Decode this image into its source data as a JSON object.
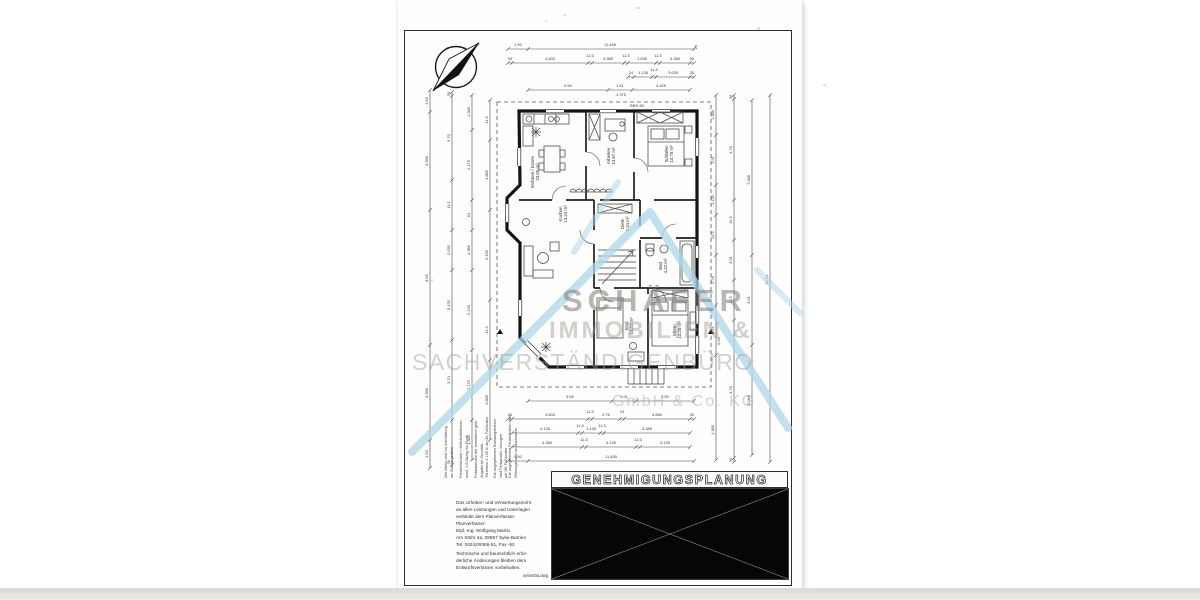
{
  "meta": {
    "document_type": "scanned architectural floor plan sheet"
  },
  "watermark": {
    "line1": "SCHÄFER",
    "line2": "IMMOBILIEN &",
    "line3": "SACHVERSTÄNDIGENBÜRO",
    "line4": "GmbH & Co. KG",
    "roof_color": "#aed7e9"
  },
  "title_block": {
    "title": "GENEHMIGUNGSPLANUNG"
  },
  "legal": {
    "copyright": {
      "lines": [
        "Das Urheber- und Verwertungsrecht",
        "an allen Leistungen und Unterlagen",
        "verbleibt dem Planverfasser.",
        "Planverfasser:",
        "Dipl.-Ing. Wolfgang Martin",
        "Am Stühr 4a, 28857 Syke-Barrien",
        "Tel. 04242/9366-51, Fax -52"
      ]
    },
    "revision": {
      "lines": [
        "Technische und baurechtlich erfor-",
        "derliche Änderungen bleiben dem",
        "Entwurfsverfasser vorbehalten."
      ]
    },
    "filename": "oebe00a.dwg"
  },
  "plan": {
    "level_label": "0.00",
    "dim_chains": [
      {
        "d": "h",
        "y": 49,
        "x1": 508,
        "x2": 694,
        "ticks": [
          508,
          528,
          694
        ]
      },
      {
        "d": "h",
        "y": 63,
        "x1": 508,
        "x2": 694,
        "ticks": [
          508,
          512,
          588,
          592,
          624,
          628,
          656,
          660,
          690,
          694
        ]
      },
      {
        "d": "h",
        "y": 77,
        "x1": 628,
        "x2": 694,
        "ticks": [
          628,
          634,
          652,
          656,
          690,
          694
        ]
      },
      {
        "d": "h",
        "y": 90,
        "x1": 528,
        "x2": 690,
        "ticks": [
          528,
          608,
          632,
          690
        ]
      },
      {
        "d": "h",
        "y": 401,
        "x1": 528,
        "x2": 694,
        "ticks": [
          528,
          612,
          636,
          694
        ]
      },
      {
        "d": "h",
        "y": 419,
        "x1": 508,
        "x2": 694,
        "ticks": [
          508,
          512,
          588,
          592,
          620,
          624,
          690,
          694
        ]
      },
      {
        "d": "h",
        "y": 433,
        "x1": 512,
        "x2": 690,
        "ticks": [
          512,
          578,
          582,
          600,
          604,
          690
        ]
      },
      {
        "d": "h",
        "y": 447,
        "x1": 512,
        "x2": 690,
        "ticks": [
          512,
          582,
          586,
          636,
          640,
          690
        ]
      },
      {
        "d": "h",
        "y": 461,
        "x1": 508,
        "x2": 694,
        "ticks": [
          508,
          528,
          694
        ]
      },
      {
        "d": "v",
        "x": 430,
        "y1": 90,
        "y2": 468,
        "ticks": [
          90,
          112,
          210,
          345,
          440,
          468
        ]
      },
      {
        "d": "v",
        "x": 452,
        "y1": 92,
        "y2": 465,
        "ticks": [
          92,
          96,
          180,
          230,
          270,
          340,
          420,
          465
        ]
      },
      {
        "d": "v",
        "x": 472,
        "y1": 95,
        "y2": 460,
        "ticks": [
          95,
          130,
          200,
          230,
          270,
          350,
          420,
          460
        ]
      },
      {
        "d": "v",
        "x": 490,
        "y1": 100,
        "y2": 440,
        "ticks": [
          100,
          140,
          210,
          300,
          360,
          440
        ]
      },
      {
        "d": "v",
        "x": 716,
        "y1": 95,
        "y2": 460,
        "ticks": [
          95,
          135,
          185,
          215,
          255,
          305,
          355,
          460
        ]
      },
      {
        "d": "v",
        "x": 734,
        "y1": 95,
        "y2": 462,
        "ticks": [
          95,
          99,
          200,
          240,
          280,
          320,
          458,
          462
        ]
      },
      {
        "d": "v",
        "x": 752,
        "y1": 100,
        "y2": 455,
        "ticks": [
          100,
          255,
          345,
          455
        ]
      },
      {
        "d": "v",
        "x": 770,
        "y1": 95,
        "y2": 462,
        "ticks": [
          95,
          462
        ]
      }
    ],
    "dim_labels": [
      {
        "t": "1.50",
        "x": 518,
        "y": 46
      },
      {
        "t": "11.485",
        "x": 610,
        "y": 46
      },
      {
        "t": "25",
        "x": 697,
        "y": 47,
        "r": -90
      },
      {
        "t": "30",
        "x": 510,
        "y": 60
      },
      {
        "t": "4.630",
        "x": 550,
        "y": 60
      },
      {
        "t": "11.5",
        "x": 590,
        "y": 57
      },
      {
        "t": "3.385",
        "x": 608,
        "y": 60
      },
      {
        "t": "11.5",
        "x": 626,
        "y": 57
      },
      {
        "t": "1.635",
        "x": 642,
        "y": 60
      },
      {
        "t": "11.5",
        "x": 658,
        "y": 57
      },
      {
        "t": "3.385",
        "x": 675,
        "y": 60
      },
      {
        "t": "30",
        "x": 692,
        "y": 60
      },
      {
        "t": "24",
        "x": 631,
        "y": 74
      },
      {
        "t": "1.135",
        "x": 643,
        "y": 74
      },
      {
        "t": "11.5",
        "x": 654,
        "y": 71
      },
      {
        "t": "3.635",
        "x": 673,
        "y": 74
      },
      {
        "t": "30",
        "x": 692,
        "y": 74
      },
      {
        "t": "5.55",
        "x": 568,
        "y": 87
      },
      {
        "t": "1.51",
        "x": 620,
        "y": 87
      },
      {
        "t": "4.425",
        "x": 661,
        "y": 87
      },
      {
        "t": "1.375",
        "x": 621,
        "y": 96
      },
      {
        "t": "BRH 80",
        "x": 637,
        "y": 107
      },
      {
        "t": "5.55",
        "x": 570,
        "y": 398
      },
      {
        "t": "1.91",
        "x": 624,
        "y": 398
      },
      {
        "t": "4.50",
        "x": 665,
        "y": 398
      },
      {
        "t": "30",
        "x": 510,
        "y": 416
      },
      {
        "t": "4.630",
        "x": 550,
        "y": 416
      },
      {
        "t": "11.5",
        "x": 590,
        "y": 413
      },
      {
        "t": "2.76",
        "x": 606,
        "y": 416
      },
      {
        "t": "24",
        "x": 622,
        "y": 413
      },
      {
        "t": "4.885",
        "x": 657,
        "y": 416
      },
      {
        "t": "30",
        "x": 692,
        "y": 416
      },
      {
        "t": "4.135",
        "x": 545,
        "y": 430
      },
      {
        "t": "11.5",
        "x": 580,
        "y": 427
      },
      {
        "t": "1.135",
        "x": 591,
        "y": 430
      },
      {
        "t": "11.5",
        "x": 602,
        "y": 427
      },
      {
        "t": "3.385",
        "x": 647,
        "y": 430
      },
      {
        "t": "4.385",
        "x": 547,
        "y": 444
      },
      {
        "t": "11.5",
        "x": 584,
        "y": 441
      },
      {
        "t": "3.135",
        "x": 611,
        "y": 444
      },
      {
        "t": "11.5",
        "x": 638,
        "y": 441
      },
      {
        "t": "3.135",
        "x": 665,
        "y": 444
      },
      {
        "t": "1.50",
        "x": 518,
        "y": 458
      },
      {
        "t": "11.485",
        "x": 611,
        "y": 458
      },
      {
        "t": "1.50",
        "x": 428,
        "y": 101,
        "r": -90
      },
      {
        "t": "4.365",
        "x": 428,
        "y": 161,
        "r": -90
      },
      {
        "t": "8.65",
        "x": 428,
        "y": 278,
        "r": -90
      },
      {
        "t": "4.365",
        "x": 428,
        "y": 393,
        "r": -90
      },
      {
        "t": "1.50",
        "x": 428,
        "y": 454,
        "r": -90
      },
      {
        "t": "30",
        "x": 450,
        "y": 94,
        "r": -90
      },
      {
        "t": "5.70",
        "x": 450,
        "y": 138,
        "r": -90
      },
      {
        "t": "11.5",
        "x": 450,
        "y": 205,
        "r": -90
      },
      {
        "t": "2.635",
        "x": 450,
        "y": 250,
        "r": -90
      },
      {
        "t": "5.135",
        "x": 450,
        "y": 305,
        "r": -90
      },
      {
        "t": "3.70",
        "x": 450,
        "y": 380,
        "r": -90
      },
      {
        "t": "30",
        "x": 450,
        "y": 462,
        "r": -90
      },
      {
        "t": "1.385",
        "x": 470,
        "y": 112,
        "r": -90
      },
      {
        "t": "2.175",
        "x": 470,
        "y": 165,
        "r": -90
      },
      {
        "t": "61",
        "x": 470,
        "y": 215,
        "r": -90
      },
      {
        "t": "1.385",
        "x": 470,
        "y": 250,
        "r": -90
      },
      {
        "t": "5.135",
        "x": 470,
        "y": 310,
        "r": -90
      },
      {
        "t": "2.175",
        "x": 470,
        "y": 385,
        "r": -90
      },
      {
        "t": "1.385",
        "x": 470,
        "y": 440,
        "r": -90
      },
      {
        "t": "11.5",
        "x": 488,
        "y": 120,
        "r": -90
      },
      {
        "t": "1.885",
        "x": 488,
        "y": 175,
        "r": -90
      },
      {
        "t": "2.135",
        "x": 488,
        "y": 255,
        "r": -90
      },
      {
        "t": "11.5",
        "x": 488,
        "y": 330,
        "r": -90
      },
      {
        "t": "1.885",
        "x": 488,
        "y": 400,
        "r": -90
      },
      {
        "t": "1.385",
        "x": 714,
        "y": 115,
        "r": -90
      },
      {
        "t": "1.51",
        "x": 714,
        "y": 160,
        "r": -90
      },
      {
        "t": "1.135",
        "x": 714,
        "y": 200,
        "r": -90
      },
      {
        "t": "11.5",
        "x": 714,
        "y": 235,
        "r": -90
      },
      {
        "t": "2.26",
        "x": 714,
        "y": 280,
        "r": -90
      },
      {
        "t": "1.51",
        "x": 714,
        "y": 330,
        "r": -90
      },
      {
        "t": "1.385",
        "x": 714,
        "y": 430,
        "r": -90
      },
      {
        "t": "30",
        "x": 732,
        "y": 97,
        "r": -90
      },
      {
        "t": "4.76",
        "x": 732,
        "y": 150,
        "r": -90
      },
      {
        "t": "11.5",
        "x": 732,
        "y": 220,
        "r": -90
      },
      {
        "t": "3.01",
        "x": 732,
        "y": 260,
        "r": -90
      },
      {
        "t": "11.5",
        "x": 732,
        "y": 300,
        "r": -90
      },
      {
        "t": "4.76",
        "x": 732,
        "y": 390,
        "r": -90
      },
      {
        "t": "30",
        "x": 732,
        "y": 460,
        "r": -90
      },
      {
        "t": "7.085",
        "x": 750,
        "y": 180,
        "r": -90
      },
      {
        "t": "3.01",
        "x": 750,
        "y": 300,
        "r": -90
      },
      {
        "t": "5.085",
        "x": 750,
        "y": 400,
        "r": -90
      },
      {
        "t": "13.74",
        "x": 768,
        "y": 280,
        "r": -90
      },
      {
        "t": "0.00",
        "x": 720,
        "y": 341,
        "r": -90
      }
    ],
    "room_labels": [
      {
        "name": "Wohnen / Essen",
        "area": "23.65 m²",
        "x": 534,
        "y": 172
      },
      {
        "name": "Kochen",
        "area": "13.24 m²",
        "x": 562,
        "y": 214
      },
      {
        "name": "Arbeiten",
        "area": "13.87 m²",
        "x": 610,
        "y": 156
      },
      {
        "name": "Schlafen",
        "area": "14.75 m²",
        "x": 668,
        "y": 154
      },
      {
        "name": "Diele",
        "area": "9.24 m²",
        "x": 624,
        "y": 224
      },
      {
        "name": "Bad",
        "area": "4.22 m²",
        "x": 662,
        "y": 266
      },
      {
        "name": "Kind",
        "area": "14.23 m²",
        "x": 628,
        "y": 326
      },
      {
        "name": "Eltern",
        "area": "13.25 m²",
        "x": 676,
        "y": 330
      }
    ],
    "note_columns": [
      {
        "x": 444,
        "lines": [
          "Alle Maße sind vor Ausführung",
          "am Bau zu prüfen!"
        ]
      },
      {
        "x": 459,
        "lines": [
          "Fensterflächen = Nettolichtflächen,",
          "mind. 1/8 Abzug für Profil"
        ]
      },
      {
        "x": 474,
        "lines": [
          "Rohbaumaße der Innentüren gem.",
          "Angabe im Grundriß,",
          "Türhöhen 2.135 m ab OK Fußboden"
        ]
      },
      {
        "x": 493,
        "lines": [
          "Die angegebenen Brüstungshöhen",
          "sind Fertigmaße, bezogen",
          "auf OK Fußboden"
        ]
      },
      {
        "x": 508,
        "lines": [
          "Die angegebenen Fensterhöhen sind",
          "Öffnungsmaße im Mauerwerk."
        ]
      }
    ]
  },
  "artifacts": {
    "speckles": [
      {
        "x": 563,
        "y": 14,
        "w": 3,
        "h": 2
      },
      {
        "x": 636,
        "y": 7,
        "w": 4,
        "h": 2
      },
      {
        "x": 757,
        "y": 27,
        "w": 3,
        "h": 3
      },
      {
        "x": 823,
        "y": 84,
        "w": 3,
        "h": 2
      },
      {
        "x": 431,
        "y": 279,
        "w": 2,
        "h": 3
      },
      {
        "x": 545,
        "y": 20,
        "w": 2,
        "h": 2
      }
    ]
  }
}
